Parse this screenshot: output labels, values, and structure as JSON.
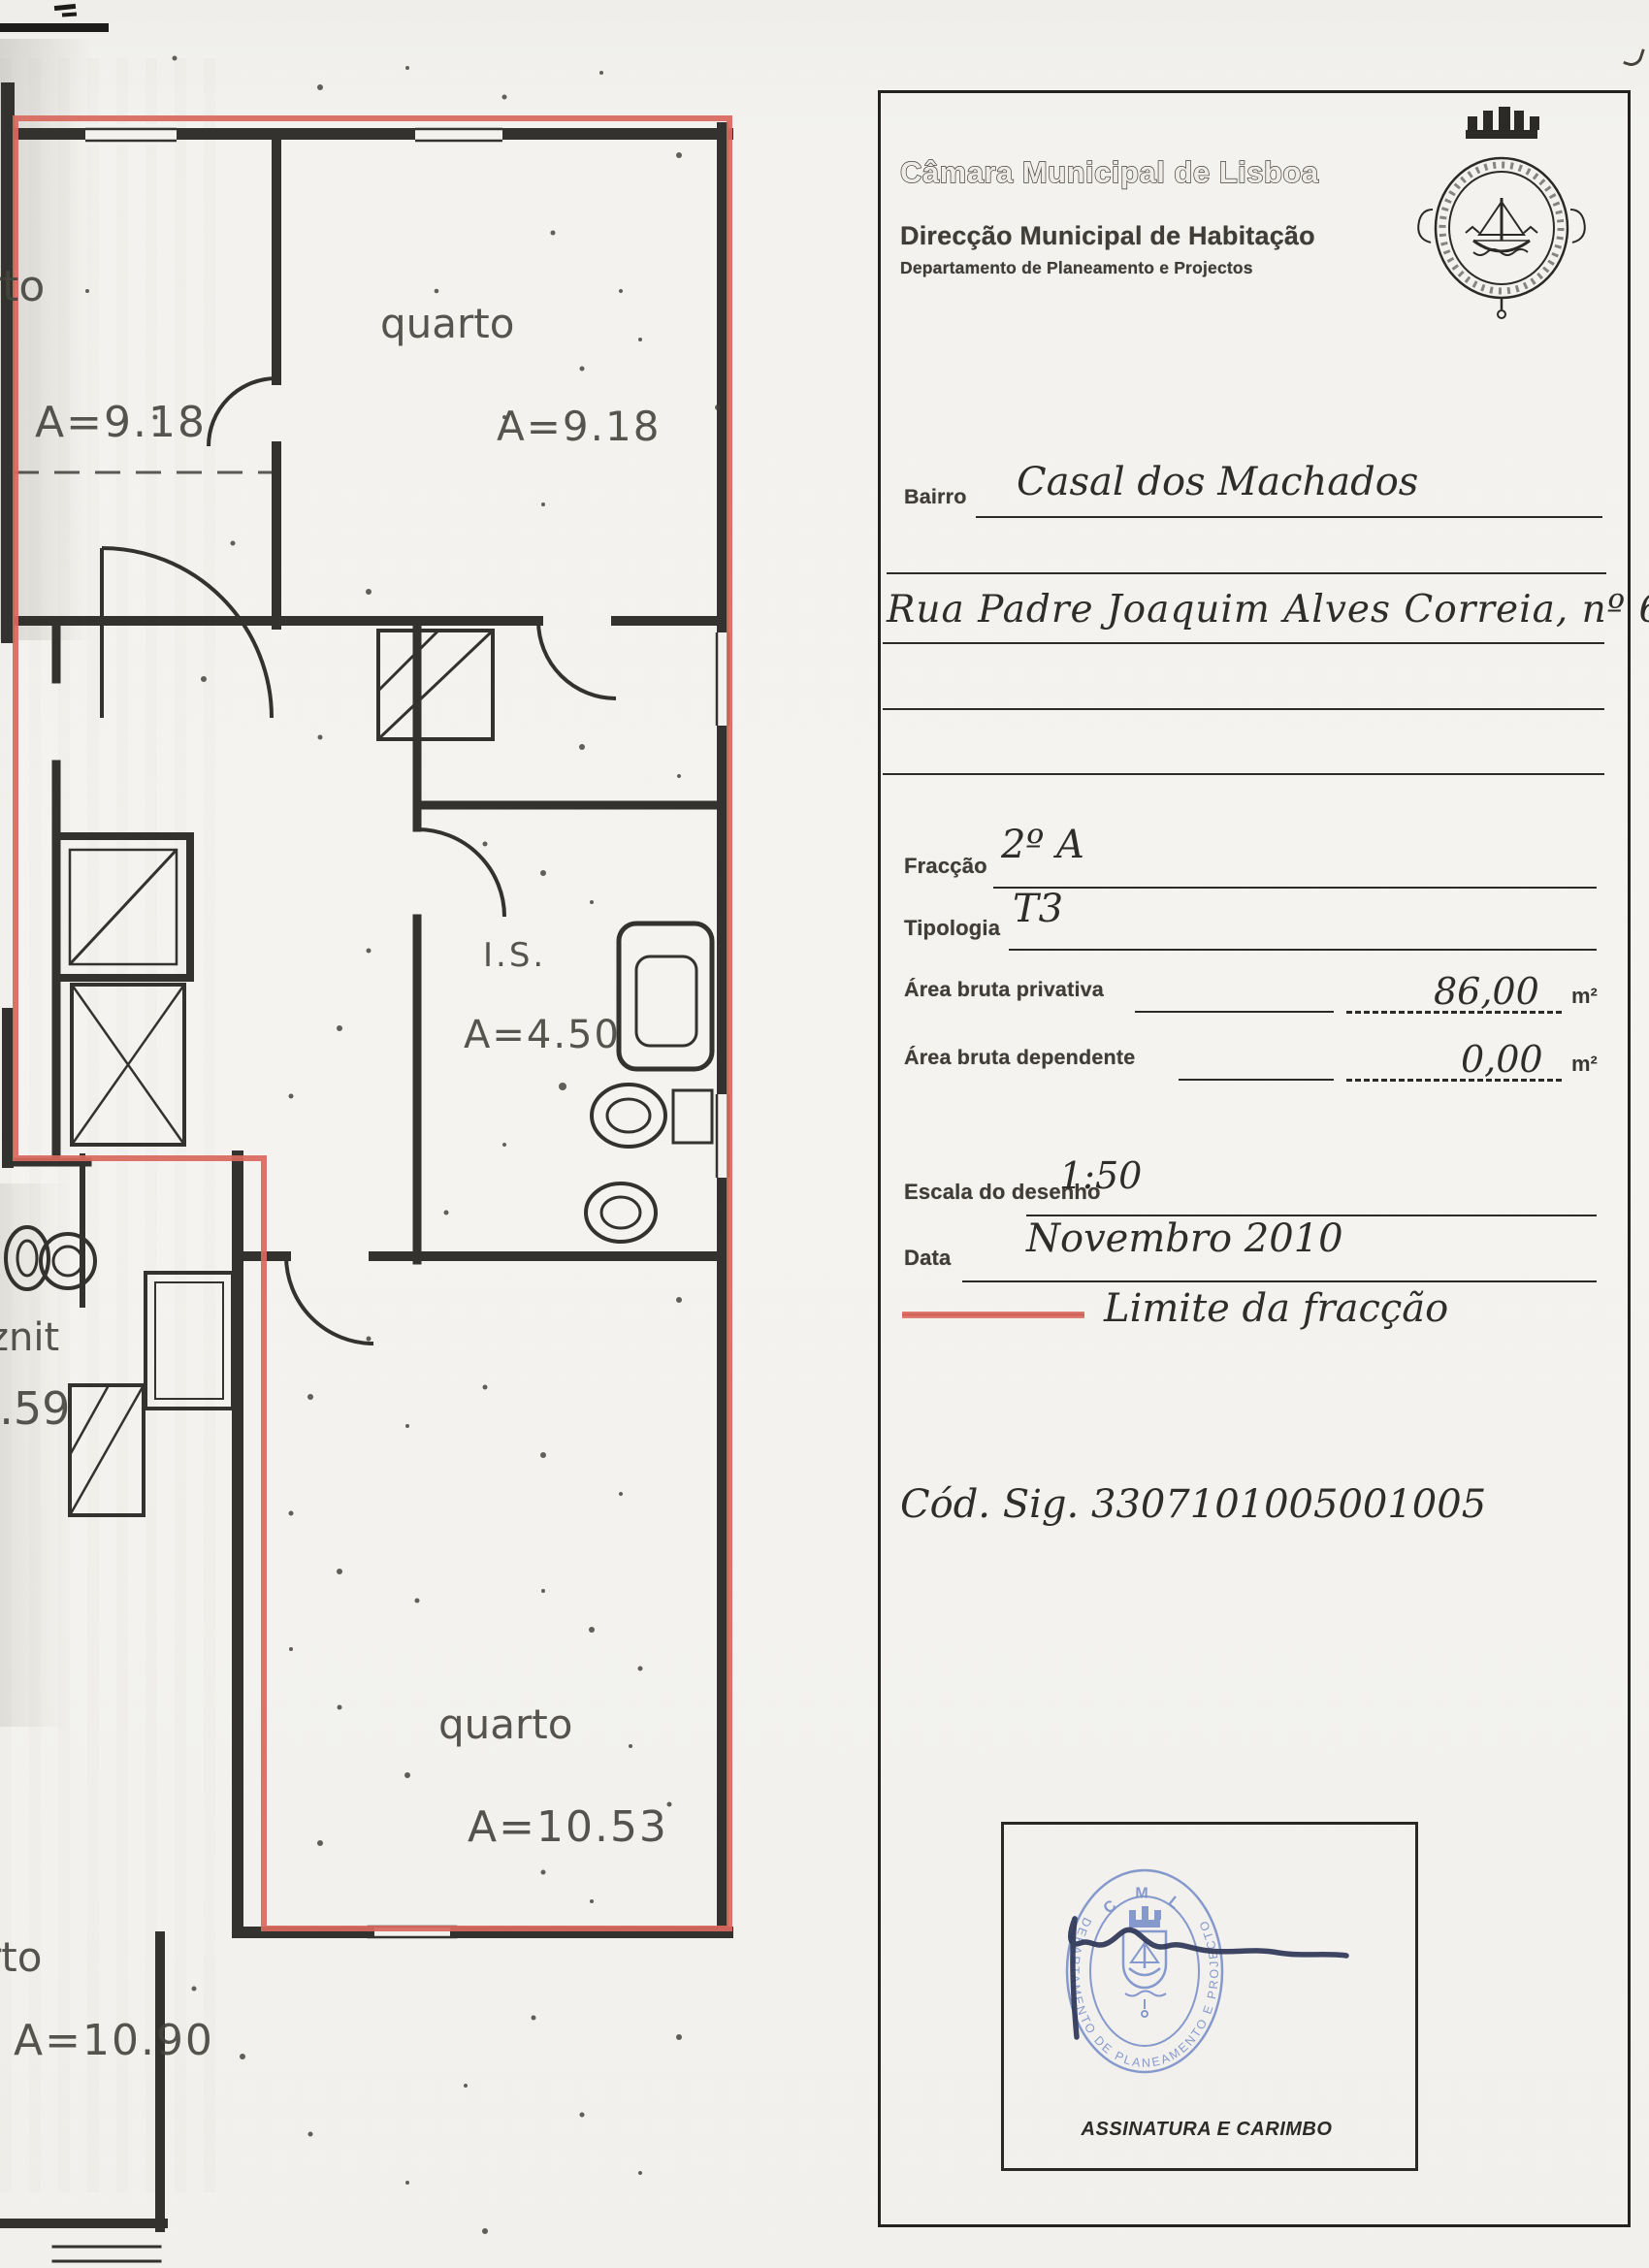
{
  "header": {
    "municipality": "Câmara Municipal de Lisboa",
    "directorate": "Direcção Municipal de Habitação",
    "department": "Departamento de Planeamento e Projectos"
  },
  "form": {
    "bairro": {
      "label": "Bairro",
      "value": "Casal dos Machados"
    },
    "address": {
      "value": "Rua Padre Joaquim Alves Correia, nº 6"
    },
    "fraccao": {
      "label": "Fracção",
      "value": "2º A"
    },
    "tipologia": {
      "label": "Tipologia",
      "value": "T3"
    },
    "area_privativa": {
      "label": "Área bruta privativa",
      "value": "86,00",
      "unit": "m²"
    },
    "area_dependente": {
      "label": "Área bruta dependente",
      "value": "0,00",
      "unit": "m²"
    },
    "escala": {
      "label": "Escala do desenho",
      "value": "1:50"
    },
    "data": {
      "label": "Data",
      "value": "Novembro 2010"
    },
    "legend": {
      "label": "Limite da fracção"
    },
    "cod_sig": {
      "value": "Cód. Sig. 3307101005001005"
    }
  },
  "stamp": {
    "org_abbrev": "C M L",
    "ring_text": "DEPARTAMENTO DE PLANEAMENTO E PROJECTOS",
    "caption": "ASSINATURA E CARIMBO"
  },
  "plan": {
    "labels": {
      "room1_name": "rto",
      "room1_area": "A=9.18",
      "room2_name": "quarto",
      "room2_area": "A=9.18",
      "bath_name": "I.S.",
      "bath_area": "A=4.50",
      "left_name": "znit",
      "left_area": "1.59",
      "room3_name": "quarto",
      "room3_area": "A=10.53",
      "room4_name": "rto",
      "room4_area": "A=10.90"
    }
  },
  "colors": {
    "fraction_boundary": "#d9685e",
    "stamp_blue": "#7b90c9",
    "ink": "#34322e"
  }
}
